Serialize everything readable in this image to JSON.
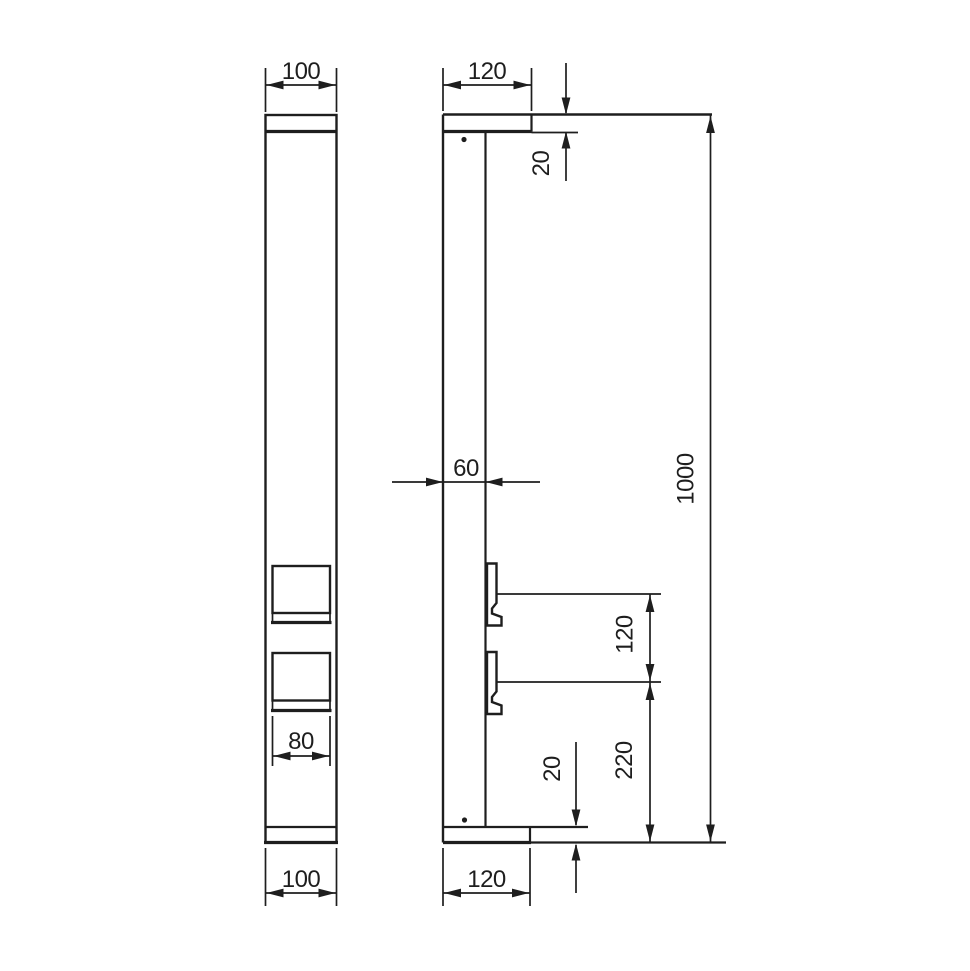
{
  "meta": {
    "type": "technical-drawing",
    "subject": "Rectangular post / bollard with two socket outlets, front and side elevations",
    "units": "mm"
  },
  "palette": {
    "line": "#1e1e1e",
    "background": "#ffffff"
  },
  "dims": {
    "front_top_width": "100",
    "front_socket_width": "80",
    "front_bottom_width": "100",
    "side_top_width": "120",
    "side_cap_thickness": "20",
    "side_body_depth": "60",
    "side_socket_spacing": "120",
    "side_lower_socket_height": "220",
    "side_base_thickness": "20",
    "side_bottom_width": "120",
    "side_total_height": "1000"
  }
}
